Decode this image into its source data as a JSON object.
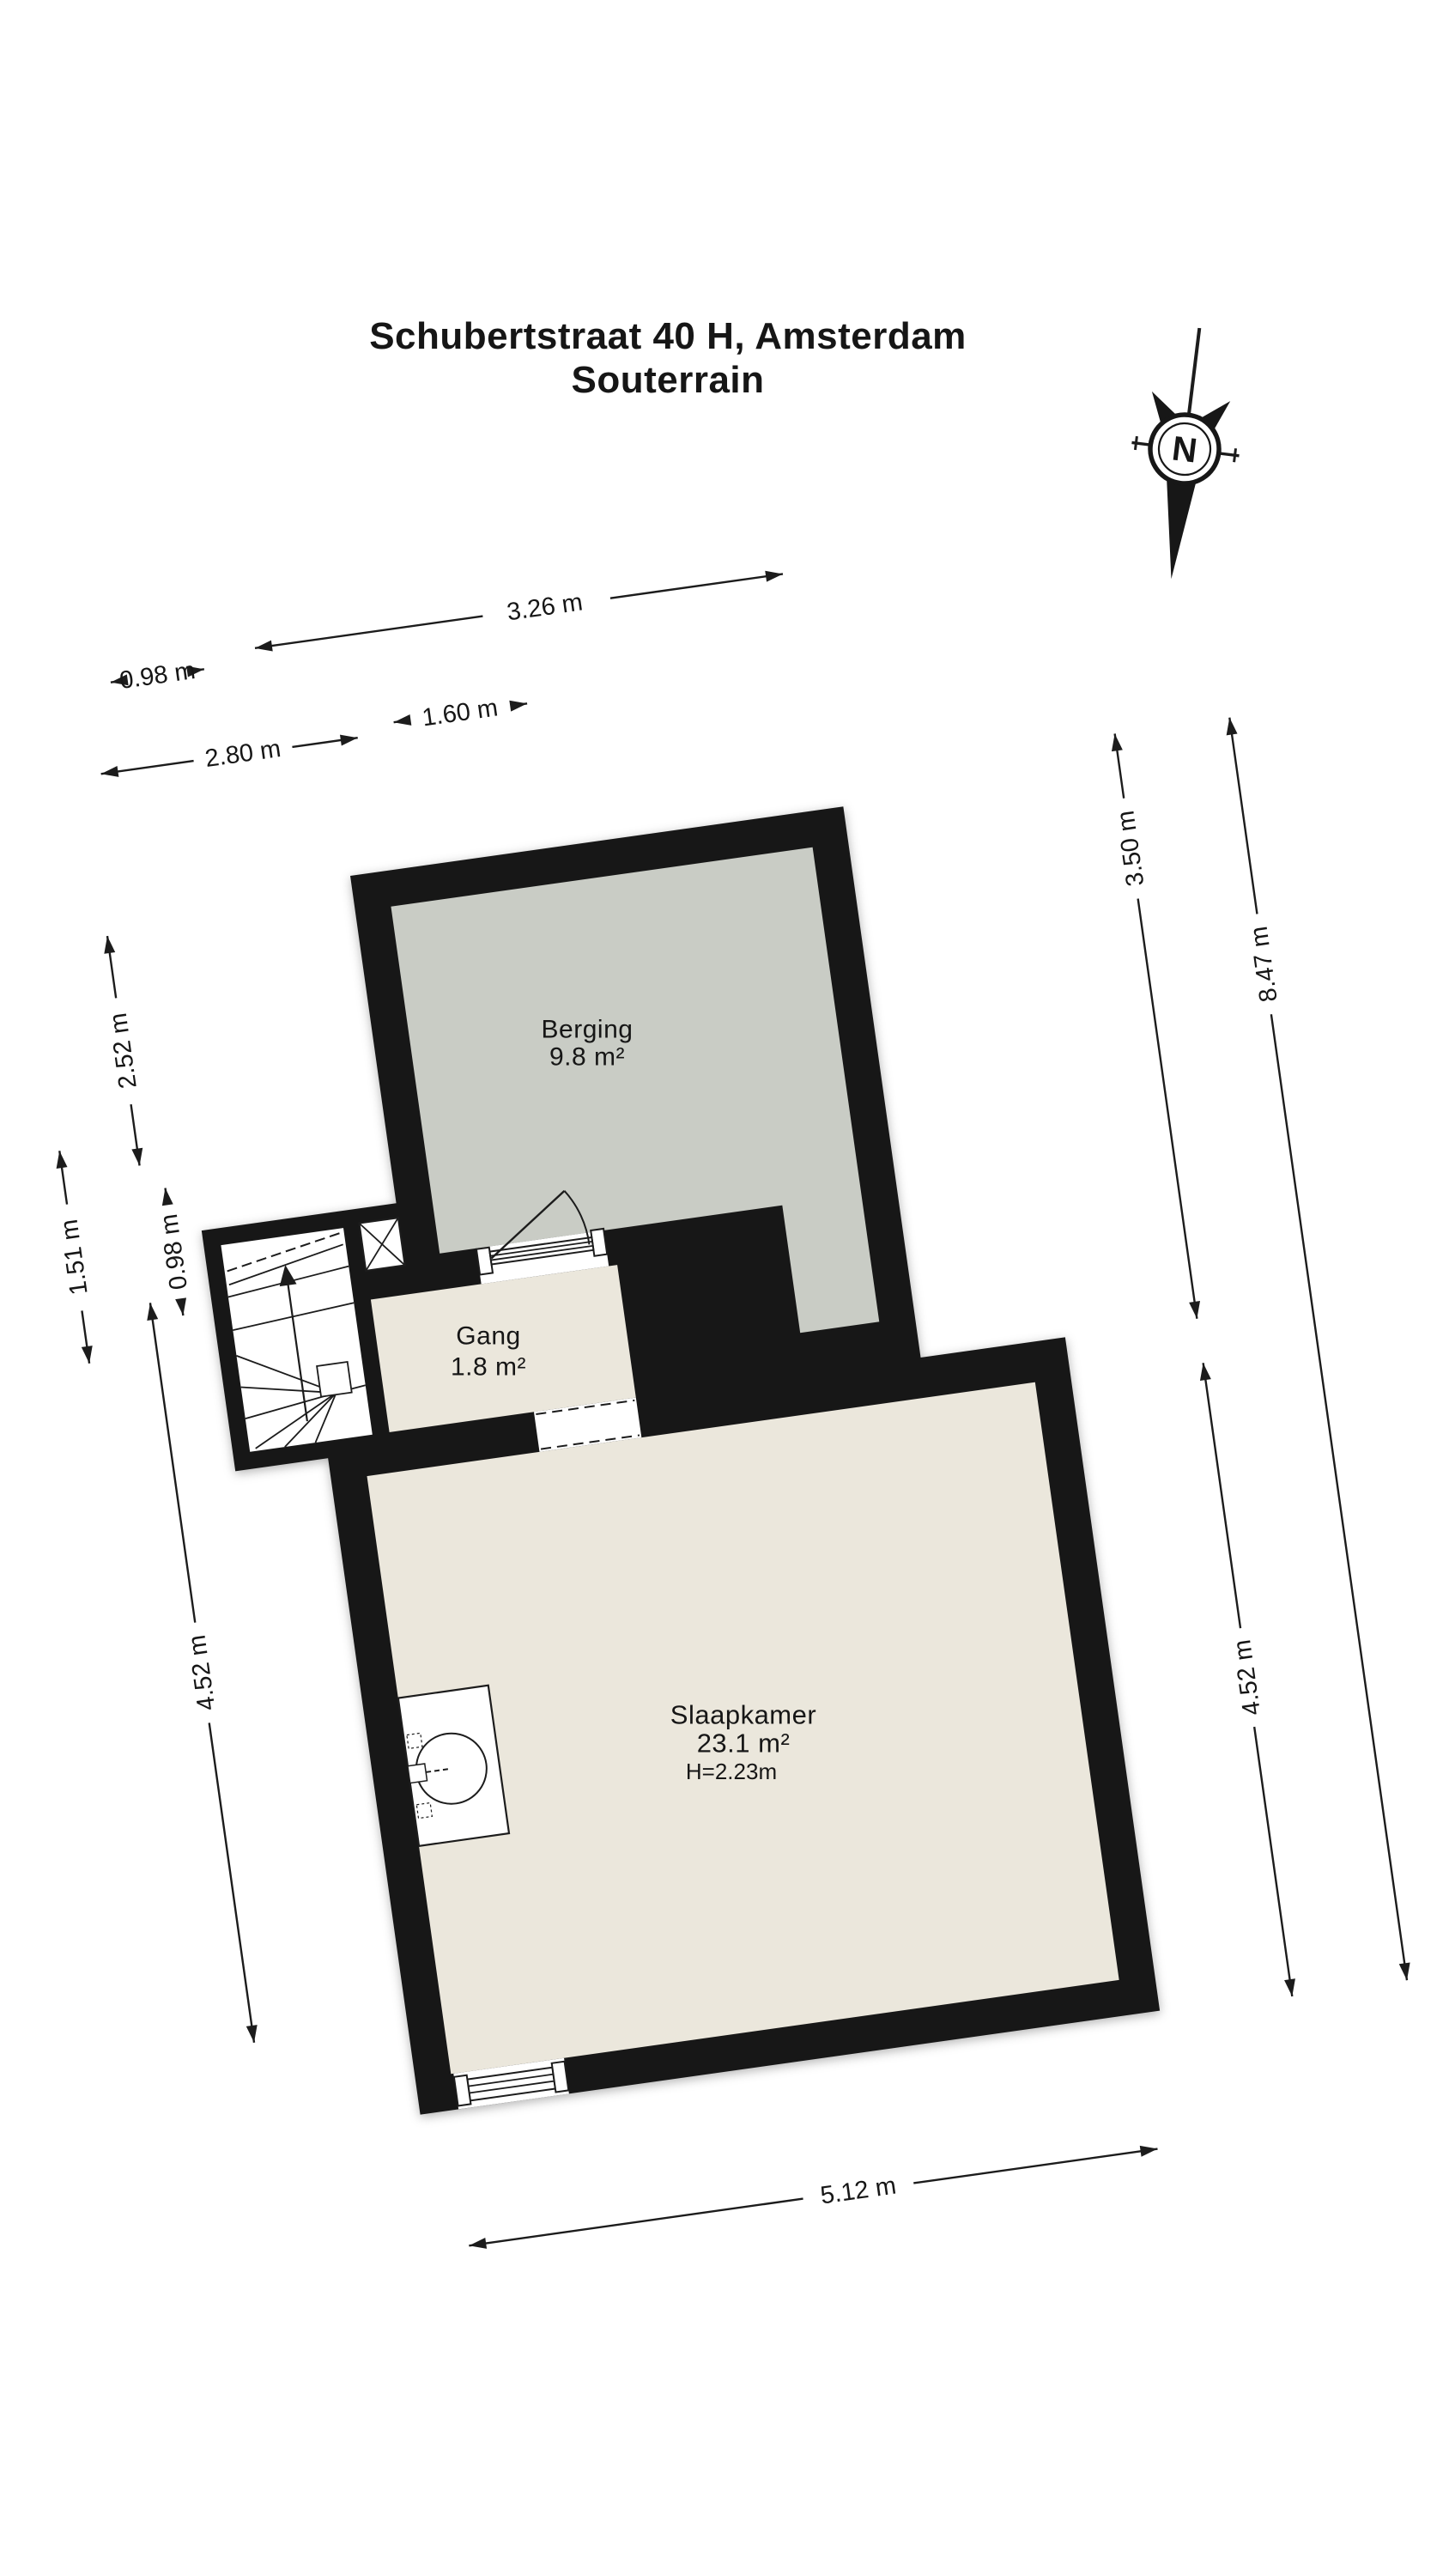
{
  "title": {
    "line1": "Schubertstraat 40 H, Amsterdam",
    "line2": "Souterrain"
  },
  "compass": {
    "letter": "N"
  },
  "rooms": {
    "berging": {
      "name": "Berging",
      "area": "9.8 m²"
    },
    "gang": {
      "name": "Gang",
      "area": "1.8 m²"
    },
    "slaapkamer": {
      "name": "Slaapkamer",
      "area": "23.1 m²",
      "ceiling_height": "H=2.23m"
    }
  },
  "dimensions": {
    "top_berging_width": "3.26 m",
    "top_stair_width": "0.98 m",
    "top_door_section_width": "1.60 m",
    "top_hall_width": "2.80 m",
    "left_berging_height": "2.52 m",
    "left_stairwell_height": "1.51 m",
    "left_gang_height": "0.98 m",
    "left_slaapkamer_height": "4.52 m",
    "right_upper_height": "3.50 m",
    "right_slaapkamer_height": "4.52 m",
    "right_total_height": "8.47 m",
    "bottom_slaapkamer_width": "5.12 m"
  },
  "colors": {
    "wall": "#171717",
    "berging_floor": "#c9ccc5",
    "living_floor": "#ebe7dc",
    "background": "#ffffff",
    "line": "#1c1c1c"
  }
}
